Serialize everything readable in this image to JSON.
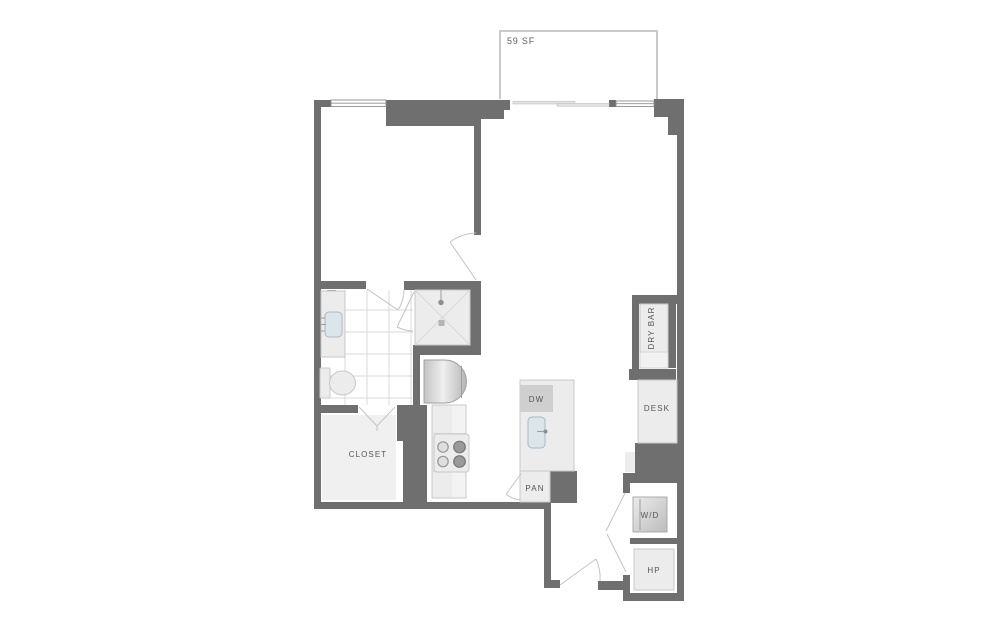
{
  "floorplan": {
    "balcony": {
      "area_label": "59 SF"
    },
    "closet": {
      "label": "CLOSET"
    },
    "kitchen": {
      "dishwasher_label": "DW",
      "pantry_label": "PAN"
    },
    "living": {
      "dry_bar_label": "DRY BAR",
      "desk_label": "DESK"
    },
    "utility": {
      "washer_dryer_label": "W/D",
      "heat_pump_label": "HP"
    },
    "colors": {
      "wall": "#6f6f6f",
      "fixture_fill": "#ececec",
      "fixture_stroke": "#c8c8c8",
      "label": "#555555",
      "balcony_outline": "#c9c9c9",
      "tile_line": "#d9d9d9",
      "door_swing": "#c4c4c4",
      "sink_fill": "#dbe5ea"
    }
  }
}
